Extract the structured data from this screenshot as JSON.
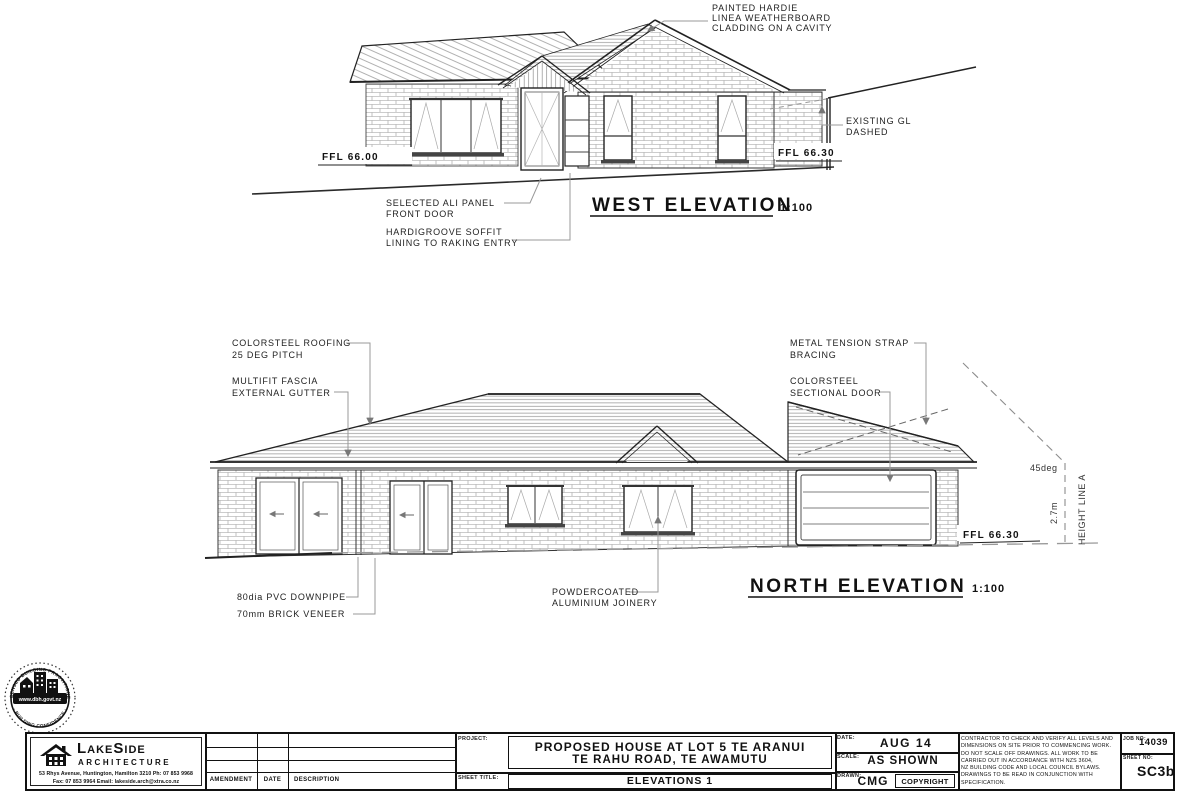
{
  "west_elevation": {
    "title": "WEST ELEVATION",
    "scale": "1:100",
    "ffl_left": "FFL 66.00",
    "ffl_right": "FFL 66.30",
    "ann_cladding": [
      "PAINTED HARDIE",
      "LINEA WEATHERBOARD",
      "CLADDING ON A CAVITY"
    ],
    "ann_existing_gl": [
      "EXISTING GL",
      "DASHED"
    ],
    "ann_front_door": [
      "SELECTED ALI PANEL",
      "FRONT DOOR"
    ],
    "ann_soffit": [
      "HARDIGROOVE SOFFIT",
      "LINING TO RAKING ENTRY"
    ]
  },
  "north_elevation": {
    "title": "NORTH ELEVATION",
    "scale": "1:100",
    "ffl": "FFL 66.30",
    "ann_roofing": [
      "COLORSTEEL ROOFING",
      "25 DEG PITCH"
    ],
    "ann_fascia": [
      "MULTIFIT FASCIA",
      "EXTERNAL GUTTER"
    ],
    "ann_strap": [
      "METAL TENSION STRAP",
      "BRACING"
    ],
    "ann_sectional_door": [
      "COLORSTEEL",
      "SECTIONAL DOOR"
    ],
    "ann_downpipe": "80dia PVC DOWNPIPE",
    "ann_brick_veneer": "70mm BRICK VENEER",
    "ann_joinery": [
      "POWDERCOATED",
      "ALUMINIUM JOINERY"
    ],
    "dim_45deg": "45deg",
    "dim_height": "2.7m",
    "height_line_label": "HEIGHT LINE A"
  },
  "stamp": {
    "arc_top": "LICENSED BUILDING PRACTITIONER",
    "arc_bottom": "· BUILDING CONFIDENCE ·",
    "website": "www.dbh.govt.nz"
  },
  "title_block": {
    "firm": {
      "name": "LakeSide",
      "type": "ARCHITECTURE",
      "address_line1": "53 Rhys Avenue, Huntington, Hamilton 3210   Ph: 07 853 9968",
      "address_line2": "Fax: 07 853 9964   Email: lakeside.arch@xtra.co.nz"
    },
    "amendment_table": {
      "headers": [
        "AMENDMENT",
        "DATE",
        "DESCRIPTION"
      ],
      "rows": [
        [
          "",
          "",
          ""
        ],
        [
          "",
          "",
          ""
        ],
        [
          "",
          "",
          ""
        ]
      ]
    },
    "project": {
      "label": "PROJECT:",
      "line1": "PROPOSED HOUSE AT LOT 5 TE ARANUI",
      "line2": "TE RAHU ROAD, TE AWAMUTU"
    },
    "sheet_title": {
      "label": "SHEET TITLE:",
      "value": "ELEVATIONS 1"
    },
    "date": {
      "label": "DATE:",
      "value": "AUG 14"
    },
    "scale": {
      "label": "SCALE:",
      "value": "AS SHOWN"
    },
    "drawn": {
      "label": "DRAWN:",
      "value": "CMG"
    },
    "copyright": "COPYRIGHT",
    "notes": [
      "CONTRACTOR TO CHECK AND VERIFY ALL LEVELS AND",
      "DIMENSIONS ON SITE PRIOR TO COMMENCING WORK.",
      "DO NOT SCALE OFF DRAWINGS. ALL WORK TO BE",
      "CARRIED OUT IN ACCORDANCE WITH NZS 3604,",
      "NZ BUILDING CODE AND LOCAL COUNCIL BYLAWS.",
      "DRAWINGS TO BE READ IN CONJUNCTION WITH",
      "SPECIFICATION."
    ],
    "job": {
      "label": "JOB NO:",
      "value": "14039"
    },
    "sheet": {
      "label": "SHEET NO:",
      "value": "SC3b"
    }
  }
}
